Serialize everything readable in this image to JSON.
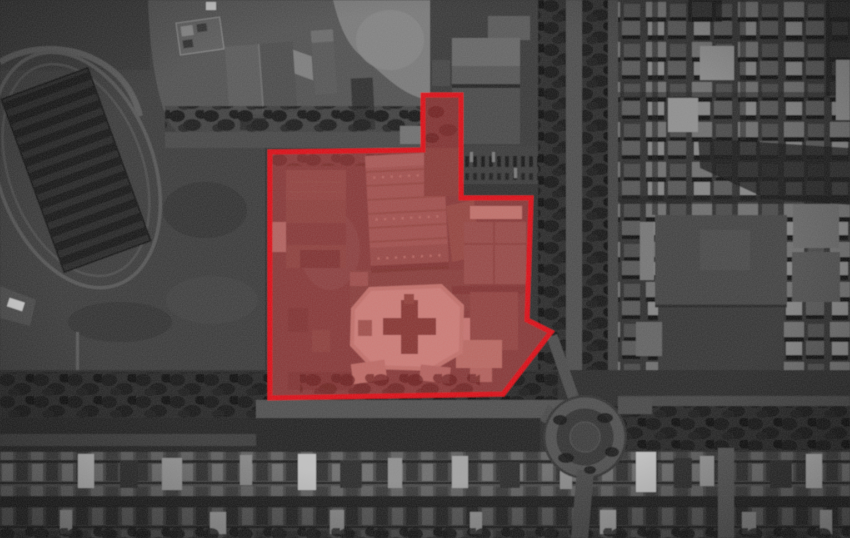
{
  "canvas": {
    "width": 850,
    "height": 538
  },
  "annotation": {
    "polygon_points": "270,152 423,150 423,95 461,95 461,198 531,198 527,320 551,332 503,394 270,398",
    "stroke_color": "#de0712",
    "stroke_width": 5,
    "fill_color": "rgba(255,45,45,0.36)",
    "interior_base_color": "#454140"
  },
  "palette": {
    "base_gray": "#2f2f2f",
    "field_gray": "#3a3a3a",
    "road_gray": "#4e4e4e",
    "tree_dark": "#141414",
    "roof_mid": "#6e6e6e",
    "roof_light": "#8a8a8a",
    "roof_bright": "#c9c9c9",
    "shadow_black": "#0f0f0f",
    "highlight_red": "#de0712"
  }
}
